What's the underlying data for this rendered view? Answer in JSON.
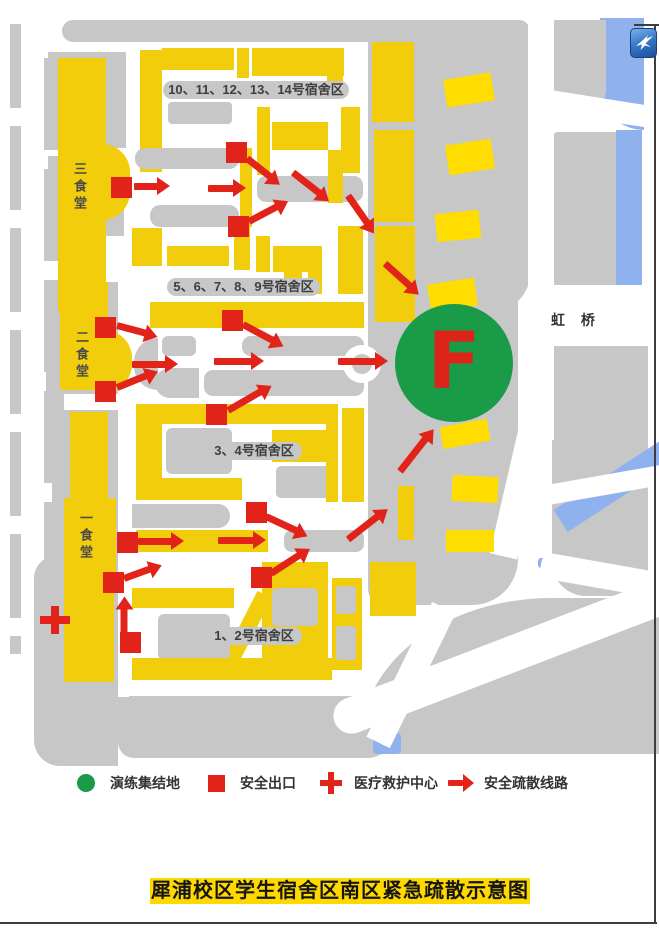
{
  "page": {
    "title": "犀浦校区学生宿舍区南区紧急疏散示意图"
  },
  "map": {
    "bridge_label": "虹 桥",
    "assembly_point": {
      "letter": "F"
    },
    "area_labels": [
      {
        "text": "10、11、12、13、14号宿舍区",
        "x": 163,
        "y": 81,
        "w": 186
      },
      {
        "text": "5、6、7、8、9号宿舍区",
        "x": 167,
        "y": 278,
        "w": 153
      },
      {
        "text": "3、4号宿舍区",
        "x": 206,
        "y": 442,
        "w": 96
      },
      {
        "text": "1、2号宿舍区",
        "x": 206,
        "y": 627,
        "w": 96
      }
    ],
    "cafeteria_labels": [
      {
        "text": "三食堂",
        "x": 70,
        "y": 162
      },
      {
        "text": "二食堂",
        "x": 72,
        "y": 330
      },
      {
        "text": "一食堂",
        "x": 76,
        "y": 511
      }
    ],
    "exits": [
      [
        236,
        152
      ],
      [
        121,
        187
      ],
      [
        238,
        226
      ],
      [
        232,
        320
      ],
      [
        105,
        327
      ],
      [
        105,
        391
      ],
      [
        216,
        414
      ],
      [
        256,
        512
      ],
      [
        127,
        542
      ],
      [
        261,
        577
      ],
      [
        113,
        582
      ],
      [
        130,
        642
      ]
    ],
    "arrows": [
      [
        247,
        158,
        38,
        30
      ],
      [
        134,
        186,
        0,
        24
      ],
      [
        208,
        188,
        0,
        26
      ],
      [
        249,
        221,
        -28,
        32
      ],
      [
        293,
        172,
        38,
        34
      ],
      [
        348,
        195,
        55,
        34
      ],
      [
        385,
        263,
        42,
        34
      ],
      [
        243,
        324,
        28,
        34
      ],
      [
        117,
        325,
        15,
        30
      ],
      [
        117,
        387,
        -22,
        32
      ],
      [
        132,
        364,
        0,
        34
      ],
      [
        214,
        361,
        0,
        38
      ],
      [
        338,
        361,
        0,
        38
      ],
      [
        228,
        410,
        -30,
        38
      ],
      [
        266,
        516,
        25,
        34
      ],
      [
        138,
        541,
        0,
        34
      ],
      [
        218,
        540,
        0,
        36
      ],
      [
        400,
        471,
        -52,
        42
      ],
      [
        348,
        539,
        -38,
        38
      ],
      [
        271,
        573,
        -33,
        34
      ],
      [
        124,
        578,
        -20,
        28
      ],
      [
        124,
        636,
        -90,
        28
      ]
    ],
    "medical": {
      "x": 55,
      "y": 620
    }
  },
  "legend": {
    "items": [
      {
        "type": "assembly",
        "label": "演练集结地",
        "x": 74
      },
      {
        "type": "exit",
        "label": "安全出口",
        "x": 204
      },
      {
        "type": "medical",
        "label": "医疗救护中心",
        "x": 318
      },
      {
        "type": "route",
        "label": "安全疏散线路",
        "x": 448
      }
    ]
  },
  "watermark": {
    "icon": "hummingbird-icon"
  },
  "colors": {
    "building_yellow": "#F2CD0C",
    "building_bright": "#FFDD00",
    "block_gray": "#C7C7C7",
    "marker_red": "#E2231A",
    "assembly_green": "#1A9B48",
    "water_blue": "#8FB2EE",
    "title_yellow": "#FFD800"
  }
}
